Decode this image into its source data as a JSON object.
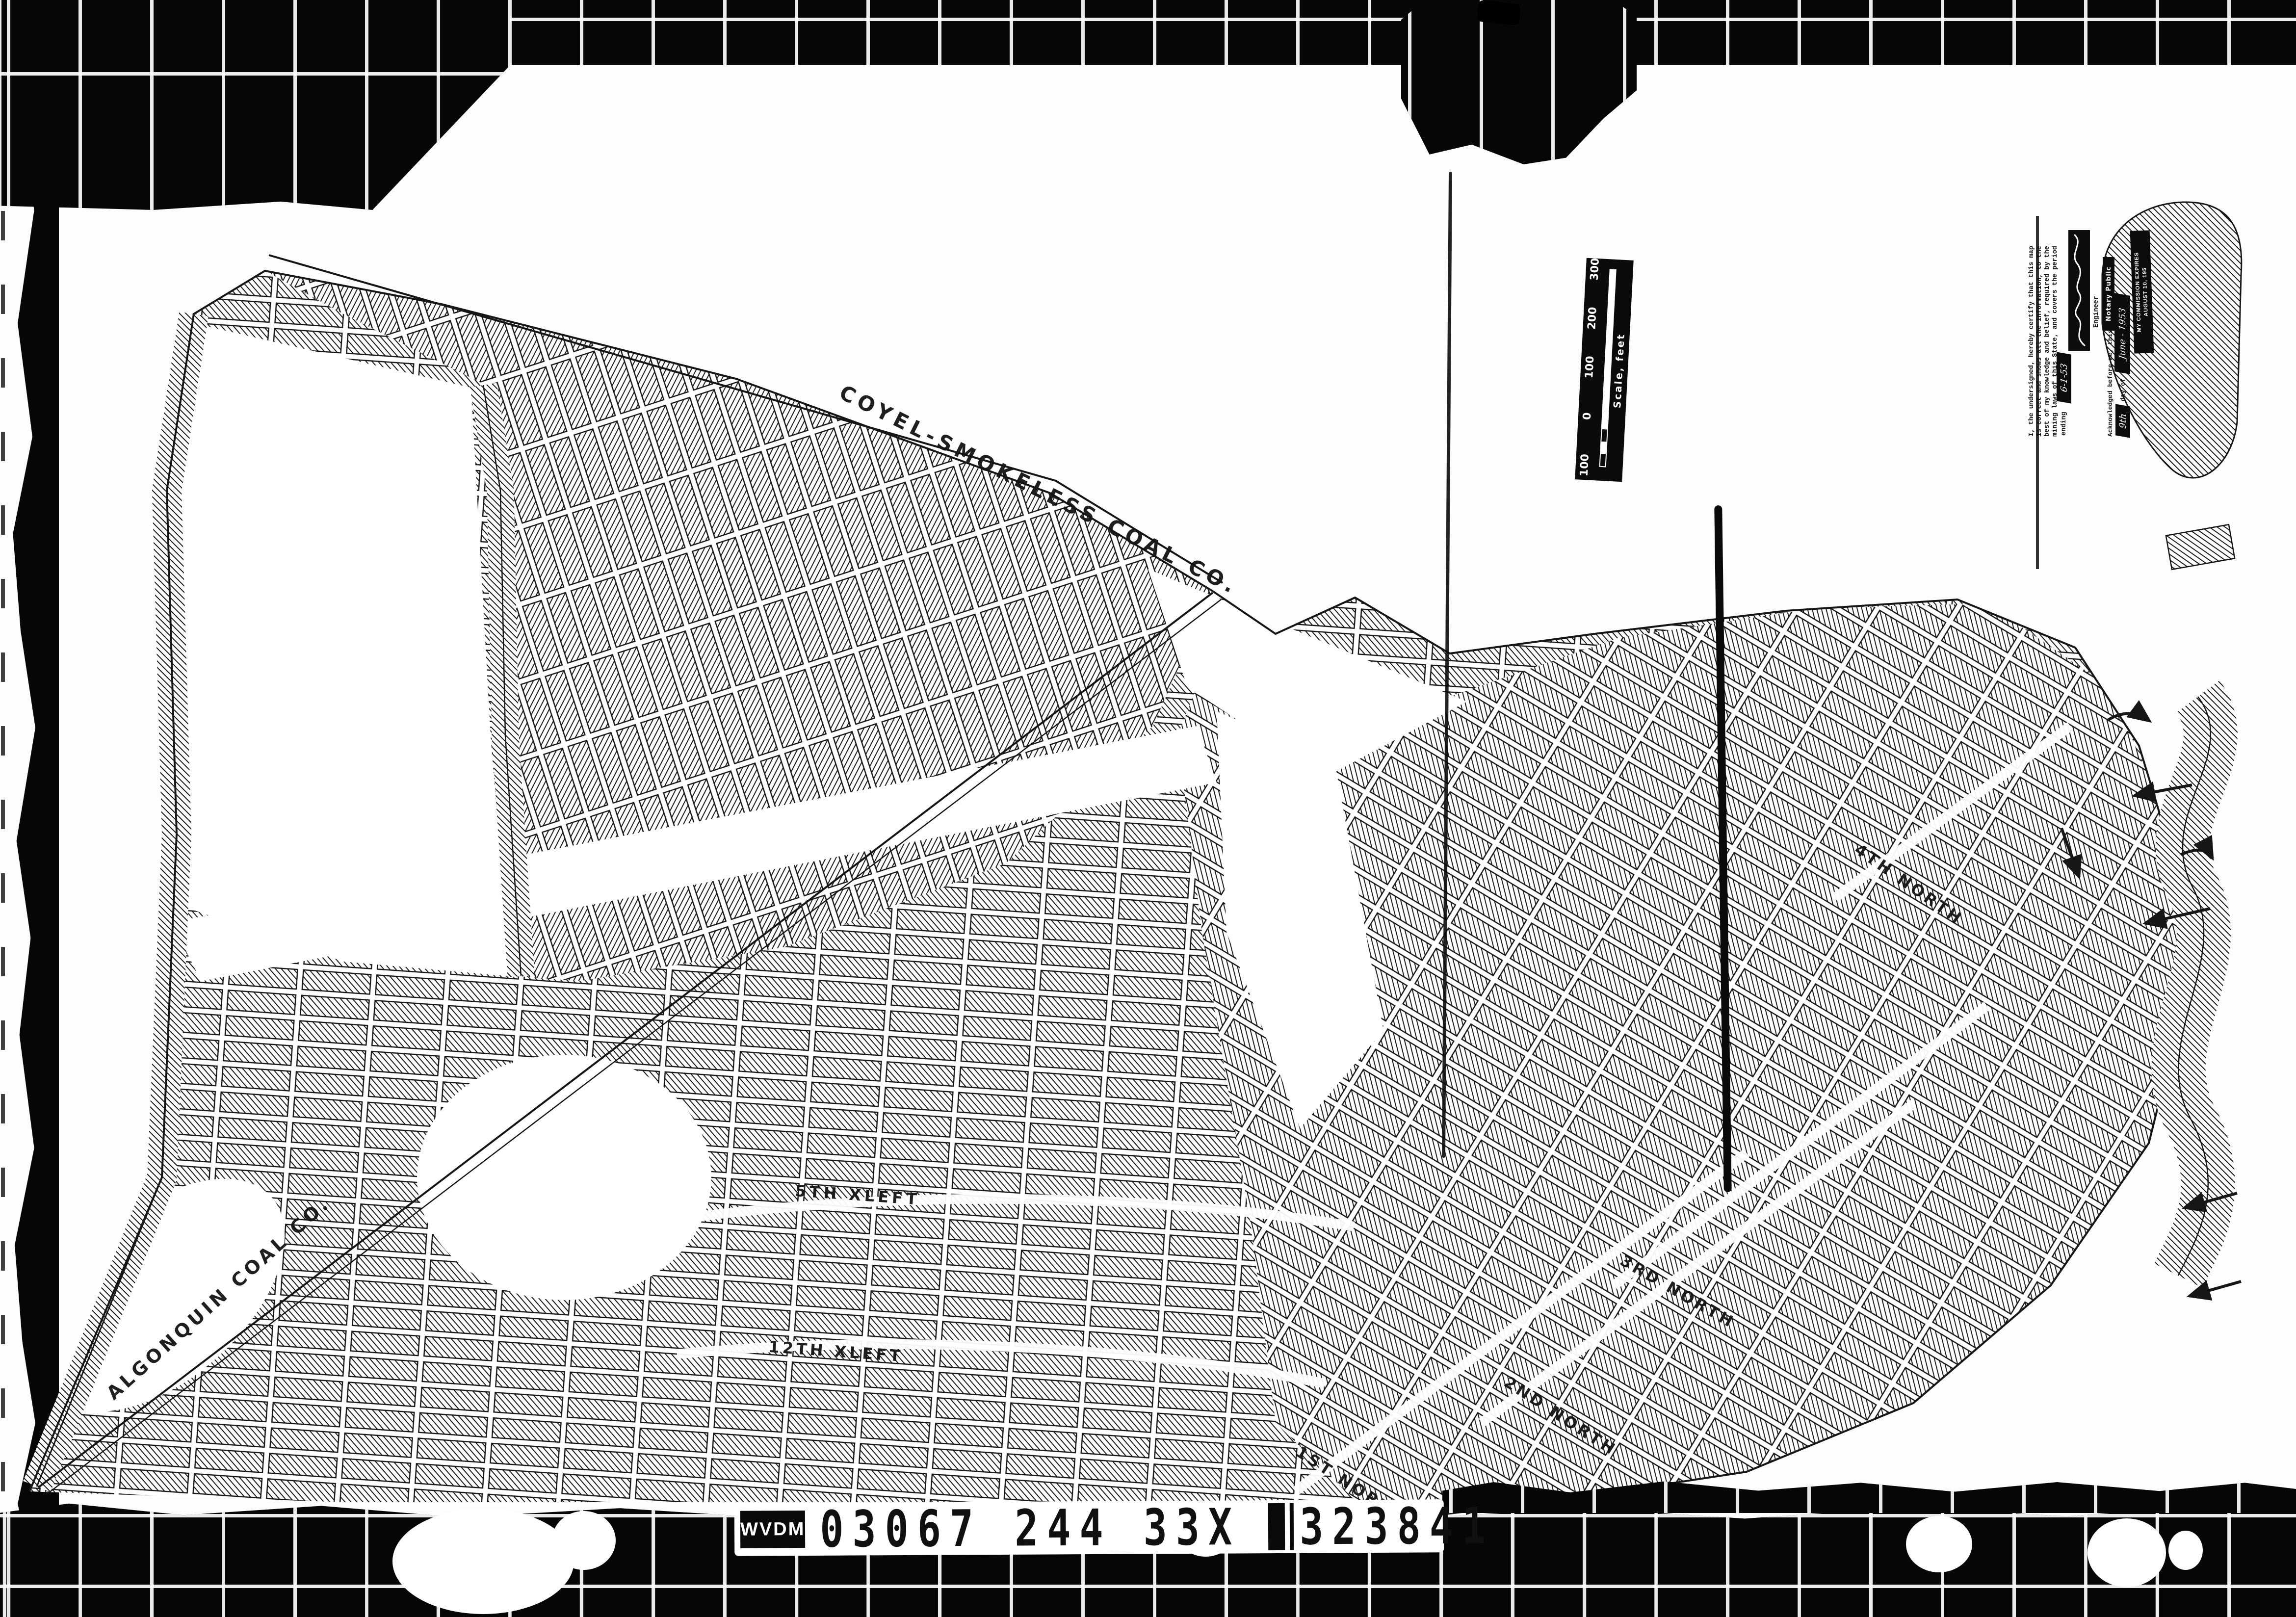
{
  "film": {
    "id_strip": {
      "prefix": "WVDM",
      "codes": [
        "03067",
        "244",
        "33X",
        "323841"
      ]
    }
  },
  "map": {
    "company_boundaries": [
      {
        "label": "COYEL-SMOKELESS COAL CO."
      },
      {
        "label": "ALGONQUIN COAL CO."
      }
    ],
    "headings": [
      {
        "label": "5TH XLEFT"
      },
      {
        "label": "12TH XLEFT"
      },
      {
        "label": "1ST NORTH"
      },
      {
        "label": "2ND NORTH"
      },
      {
        "label": "3RD NORTH"
      },
      {
        "label": "4TH NORTH"
      }
    ],
    "scale_bar": {
      "caption": "Scale, feet",
      "ticks": [
        "100",
        "0",
        "100",
        "200",
        "300"
      ]
    },
    "certification": {
      "statement_lines": [
        "I, the undersigned, hereby certify that this map",
        "is correct and shows all the information, to the",
        "best of my knowledge and belief, required by the",
        "mining laws of this State, and covers the period"
      ],
      "ending_label": "ending",
      "ending_date": "6-1-53",
      "signer_title": "Engineer",
      "ack_text": "Acknowledged before me, this",
      "ack_day": "9th",
      "ack_day_of": "day of",
      "ack_date": "June - 1953",
      "notary_title": "Notary Public",
      "stamp_line1": "MY COMMISSION EXPIRES",
      "stamp_line2": "AUGUST 10, 195"
    }
  }
}
